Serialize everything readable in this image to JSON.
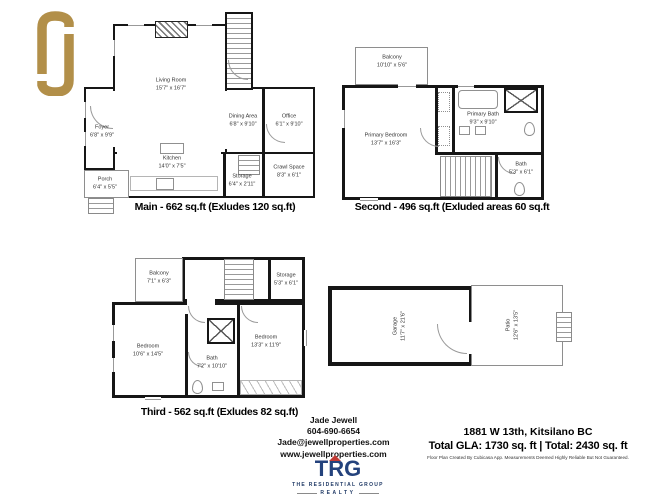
{
  "plans": {
    "main": {
      "caption": "Main - 662 sq.ft (Exludes 120 sq.ft)",
      "rooms": [
        {
          "name": "Living Room",
          "dims": "15'7\" x 16'7\""
        },
        {
          "name": "Foyer",
          "dims": "6'8\" x 9'9\""
        },
        {
          "name": "Porch",
          "dims": "6'4\" x 5'5\""
        },
        {
          "name": "Kitchen",
          "dims": "14'0\" x 7'5\""
        },
        {
          "name": "Dining Area",
          "dims": "6'8\" x 9'10\""
        },
        {
          "name": "Office",
          "dims": "6'1\" x 9'10\""
        },
        {
          "name": "Storage",
          "dims": "6'4\" x 2'11\""
        },
        {
          "name": "Crawl Space",
          "dims": "8'3\" x 6'1\""
        }
      ]
    },
    "second": {
      "caption": "Second - 496 sq.ft (Exluded areas 60 sq.ft",
      "rooms": [
        {
          "name": "Balcony",
          "dims": "10'10\" x 5'6\""
        },
        {
          "name": "Primary Bedroom",
          "dims": "13'7\" x 16'3\""
        },
        {
          "name": "Primary Bath",
          "dims": "9'3\" x 9'10\""
        },
        {
          "name": "Bath",
          "dims": "5'3\" x 6'1\""
        }
      ]
    },
    "third": {
      "caption": "Third - 562 sq.ft (Exludes 82 sq.ft)",
      "rooms": [
        {
          "name": "Balcony",
          "dims": "7'1\" x 6'3\""
        },
        {
          "name": "Storage",
          "dims": "5'3\" x 6'1\""
        },
        {
          "name": "Bedroom",
          "dims": "10'6\" x 14'5\""
        },
        {
          "name": "Bedroom",
          "dims": "13'3\" x 11'9\""
        },
        {
          "name": "Bath",
          "dims": "7'2\" x 10'10\""
        }
      ]
    },
    "garage": {
      "rooms": [
        {
          "name": "Garage",
          "dims": "11'7\" x 21'6\""
        },
        {
          "name": "Patio",
          "dims": "12'6\" x 13'5\""
        }
      ]
    }
  },
  "agent": {
    "name": "Jade Jewell",
    "phone": "604-690-6654",
    "email": "Jade@jewellproperties.com",
    "website": "www.jewellproperties.com"
  },
  "property": {
    "address": "1881 W 13th, Kitsilano BC",
    "totals": "Total GLA:  1730 sq. ft  |  Total:  2430 sq. ft",
    "disclaimer": "Floor Plan Created By Cubicasa App. Measurements Deemed Highly Reliable But Not Guaranteed."
  },
  "logos": {
    "fj_color": "#b28f49",
    "trg": {
      "name": "TRG",
      "line1": "THE RESIDENTIAL GROUP",
      "line2": "REALTY",
      "blue": "#24427c",
      "red": "#c23b35"
    }
  }
}
